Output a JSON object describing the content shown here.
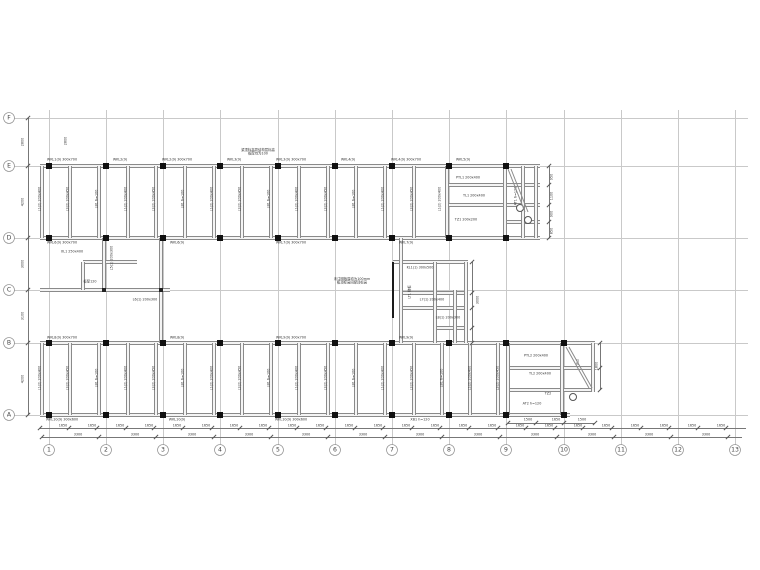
{
  "drawing": {
    "frame": {
      "x1": 14,
      "x2": 748,
      "y1": 110,
      "y2": 445,
      "bubble_row_y": 450,
      "bubble_col_x": 9
    },
    "cols": [
      {
        "n": "1",
        "x": 49
      },
      {
        "n": "2",
        "x": 106
      },
      {
        "n": "3",
        "x": 163
      },
      {
        "n": "4",
        "x": 220
      },
      {
        "n": "5",
        "x": 278
      },
      {
        "n": "6",
        "x": 335
      },
      {
        "n": "7",
        "x": 392
      },
      {
        "n": "8",
        "x": 449
      },
      {
        "n": "9",
        "x": 506
      },
      {
        "n": "10",
        "x": 564
      },
      {
        "n": "11",
        "x": 621
      },
      {
        "n": "12",
        "x": 678
      },
      {
        "n": "13",
        "x": 735
      }
    ],
    "rows": [
      {
        "n": "F",
        "y": 118
      },
      {
        "n": "E",
        "y": 166
      },
      {
        "n": "D",
        "y": 238
      },
      {
        "n": "C",
        "y": 290
      },
      {
        "n": "B",
        "y": 343
      },
      {
        "n": "A",
        "y": 415
      }
    ],
    "hbeams": [
      {
        "x": 40,
        "y": 166,
        "w": 500
      },
      {
        "x": 40,
        "y": 238,
        "w": 500
      },
      {
        "x": 447,
        "y": 185,
        "w": 93
      },
      {
        "x": 447,
        "y": 205,
        "w": 93
      },
      {
        "x": 506,
        "y": 222,
        "w": 34
      },
      {
        "x": 83,
        "y": 262,
        "w": 54
      },
      {
        "x": 40,
        "y": 290,
        "w": 130
      },
      {
        "x": 393,
        "y": 262,
        "w": 75
      },
      {
        "x": 401,
        "y": 293,
        "w": 67
      },
      {
        "x": 401,
        "y": 308,
        "w": 67
      },
      {
        "x": 435,
        "y": 328,
        "w": 33
      },
      {
        "x": 40,
        "y": 343,
        "w": 555
      },
      {
        "x": 40,
        "y": 415,
        "w": 530
      },
      {
        "x": 508,
        "y": 368,
        "w": 87
      },
      {
        "x": 508,
        "y": 390,
        "w": 87
      }
    ],
    "vbeams": [
      {
        "x": 42,
        "y": 166,
        "h": 72
      },
      {
        "x": 70,
        "y": 166,
        "h": 72
      },
      {
        "x": 99,
        "y": 166,
        "h": 72
      },
      {
        "x": 128,
        "y": 166,
        "h": 72
      },
      {
        "x": 156,
        "y": 166,
        "h": 72
      },
      {
        "x": 185,
        "y": 166,
        "h": 72
      },
      {
        "x": 214,
        "y": 166,
        "h": 72
      },
      {
        "x": 242,
        "y": 166,
        "h": 72
      },
      {
        "x": 271,
        "y": 166,
        "h": 72
      },
      {
        "x": 299,
        "y": 166,
        "h": 72
      },
      {
        "x": 328,
        "y": 166,
        "h": 72
      },
      {
        "x": 356,
        "y": 166,
        "h": 72
      },
      {
        "x": 385,
        "y": 166,
        "h": 72
      },
      {
        "x": 414,
        "y": 166,
        "h": 72
      },
      {
        "x": 447,
        "y": 166,
        "h": 72
      },
      {
        "x": 505,
        "y": 166,
        "h": 72
      },
      {
        "x": 523,
        "y": 166,
        "h": 72
      },
      {
        "x": 536,
        "y": 166,
        "h": 72
      },
      {
        "x": 104,
        "y": 238,
        "h": 52
      },
      {
        "x": 161,
        "y": 238,
        "h": 105
      },
      {
        "x": 83,
        "y": 262,
        "h": 28
      },
      {
        "x": 401,
        "y": 238,
        "h": 105
      },
      {
        "x": 435,
        "y": 262,
        "h": 81
      },
      {
        "x": 455,
        "y": 290,
        "h": 53
      },
      {
        "x": 466,
        "y": 262,
        "h": 81
      },
      {
        "x": 42,
        "y": 343,
        "h": 72
      },
      {
        "x": 70,
        "y": 343,
        "h": 72
      },
      {
        "x": 99,
        "y": 343,
        "h": 72
      },
      {
        "x": 128,
        "y": 343,
        "h": 72
      },
      {
        "x": 156,
        "y": 343,
        "h": 72
      },
      {
        "x": 185,
        "y": 343,
        "h": 72
      },
      {
        "x": 214,
        "y": 343,
        "h": 72
      },
      {
        "x": 242,
        "y": 343,
        "h": 72
      },
      {
        "x": 271,
        "y": 343,
        "h": 72
      },
      {
        "x": 299,
        "y": 343,
        "h": 72
      },
      {
        "x": 328,
        "y": 343,
        "h": 72
      },
      {
        "x": 356,
        "y": 343,
        "h": 72
      },
      {
        "x": 385,
        "y": 343,
        "h": 72
      },
      {
        "x": 414,
        "y": 343,
        "h": 72
      },
      {
        "x": 442,
        "y": 343,
        "h": 72
      },
      {
        "x": 470,
        "y": 343,
        "h": 72
      },
      {
        "x": 498,
        "y": 343,
        "h": 72
      },
      {
        "x": 508,
        "y": 343,
        "h": 72
      },
      {
        "x": 562,
        "y": 343,
        "h": 72
      },
      {
        "x": 593,
        "y": 343,
        "h": 49
      }
    ],
    "bold_lines": [
      {
        "x": 392,
        "y": 262,
        "h": 56
      }
    ],
    "columns": [
      {
        "x": 49,
        "y": 166
      },
      {
        "x": 106,
        "y": 166
      },
      {
        "x": 163,
        "y": 166
      },
      {
        "x": 220,
        "y": 166
      },
      {
        "x": 278,
        "y": 166
      },
      {
        "x": 335,
        "y": 166
      },
      {
        "x": 392,
        "y": 166
      },
      {
        "x": 449,
        "y": 166
      },
      {
        "x": 506,
        "y": 166
      },
      {
        "x": 49,
        "y": 238
      },
      {
        "x": 106,
        "y": 238
      },
      {
        "x": 163,
        "y": 238
      },
      {
        "x": 220,
        "y": 238
      },
      {
        "x": 278,
        "y": 238
      },
      {
        "x": 335,
        "y": 238
      },
      {
        "x": 392,
        "y": 238
      },
      {
        "x": 449,
        "y": 238
      },
      {
        "x": 506,
        "y": 238
      },
      {
        "x": 49,
        "y": 343
      },
      {
        "x": 106,
        "y": 343
      },
      {
        "x": 163,
        "y": 343
      },
      {
        "x": 220,
        "y": 343
      },
      {
        "x": 278,
        "y": 343
      },
      {
        "x": 335,
        "y": 343
      },
      {
        "x": 392,
        "y": 343
      },
      {
        "x": 449,
        "y": 343
      },
      {
        "x": 506,
        "y": 343
      },
      {
        "x": 564,
        "y": 343
      },
      {
        "x": 49,
        "y": 415
      },
      {
        "x": 106,
        "y": 415
      },
      {
        "x": 163,
        "y": 415
      },
      {
        "x": 220,
        "y": 415
      },
      {
        "x": 278,
        "y": 415
      },
      {
        "x": 335,
        "y": 415
      },
      {
        "x": 392,
        "y": 415
      },
      {
        "x": 449,
        "y": 415
      },
      {
        "x": 506,
        "y": 415
      },
      {
        "x": 564,
        "y": 415
      }
    ],
    "joints": [
      {
        "x": 104,
        "y": 290
      },
      {
        "x": 161,
        "y": 290
      }
    ],
    "circles": [
      {
        "x": 520,
        "y": 208
      },
      {
        "x": 528,
        "y": 220
      },
      {
        "x": 573,
        "y": 397
      }
    ],
    "diagonals": [
      {
        "x1": 508,
        "y1": 169,
        "x2": 525,
        "y2": 212
      },
      {
        "x1": 511,
        "y1": 169,
        "x2": 528,
        "y2": 212
      },
      {
        "x1": 566,
        "y1": 347,
        "x2": 589,
        "y2": 388
      },
      {
        "x1": 569,
        "y1": 347,
        "x2": 592,
        "y2": 388
      }
    ],
    "dim_lines": [
      {
        "o": "h",
        "x": 40,
        "y": 428,
        "len": 706,
        "step": 28.6
      },
      {
        "o": "h",
        "x": 42,
        "y": 437,
        "len": 700,
        "step": 57.2
      },
      {
        "o": "v",
        "x": 28,
        "y": 118,
        "len": 297,
        "ticks": [
          118,
          166,
          238,
          290,
          343,
          415
        ]
      },
      {
        "o": "v",
        "x": 549,
        "y": 166,
        "len": 72,
        "ticks": [
          166,
          185,
          205,
          222,
          238
        ]
      },
      {
        "o": "v",
        "x": 472,
        "y": 262,
        "len": 81,
        "ticks": [
          262,
          293,
          308,
          328,
          343
        ]
      },
      {
        "o": "h",
        "x": 508,
        "y": 423,
        "len": 87,
        "ticks": [
          508,
          536,
          564,
          595
        ]
      },
      {
        "o": "v",
        "x": 600,
        "y": 343,
        "len": 47,
        "ticks": [
          343,
          368,
          390
        ]
      }
    ],
    "dim_numbers": [
      {
        "t": "1650",
        "y": 426,
        "xs": [
          63,
          92,
          120,
          149,
          177,
          206,
          234,
          263,
          292,
          320,
          349,
          378,
          406,
          435,
          463,
          492,
          520,
          549,
          578,
          606,
          635,
          664,
          692,
          721
        ]
      },
      {
        "t": "3300",
        "y": 435,
        "xs": [
          78,
          135,
          192,
          249,
          306,
          363,
          420,
          478,
          535,
          592,
          649,
          706
        ]
      }
    ],
    "left_dims": [
      {
        "t": "2800",
        "x": 23,
        "y": 142
      },
      {
        "t": "4200",
        "x": 23,
        "y": 202
      },
      {
        "t": "3000",
        "x": 23,
        "y": 264
      },
      {
        "t": "3100",
        "x": 23,
        "y": 316
      },
      {
        "t": "4200",
        "x": 23,
        "y": 379
      }
    ],
    "labels": [
      {
        "t": "WKL1(9) 300x700",
        "x": 62,
        "y": 160,
        "r": 0
      },
      {
        "t": "WKL2(9)",
        "x": 120,
        "y": 160,
        "r": 0
      },
      {
        "t": "WKL2(9) 300x700",
        "x": 177,
        "y": 160,
        "r": 0
      },
      {
        "t": "WKL3(9)",
        "x": 234,
        "y": 160,
        "r": 0
      },
      {
        "t": "WKL3(9) 300x700",
        "x": 291,
        "y": 160,
        "r": 0
      },
      {
        "t": "WKL4(9)",
        "x": 348,
        "y": 160,
        "r": 0
      },
      {
        "t": "WKL4(9) 300x700",
        "x": 406,
        "y": 160,
        "r": 0
      },
      {
        "t": "WKL5(9)",
        "x": 463,
        "y": 160,
        "r": 0
      },
      {
        "t": "梁顶标高同结构层标高\n板厚均为100",
        "x": 258,
        "y": 152,
        "r": 0
      },
      {
        "t": "WKL6(9) 300x700",
        "x": 62,
        "y": 243,
        "r": 0
      },
      {
        "t": "WKL6(9)",
        "x": 177,
        "y": 243,
        "r": 0
      },
      {
        "t": "WKL7(9) 300x700",
        "x": 291,
        "y": 243,
        "r": 0
      },
      {
        "t": "WKL7(9)",
        "x": 406,
        "y": 243,
        "r": 0
      },
      {
        "t": "WKL8(9) 300x700",
        "x": 62,
        "y": 338,
        "r": 0
      },
      {
        "t": "WKL8(9)",
        "x": 177,
        "y": 338,
        "r": 0
      },
      {
        "t": "WKL9(9) 300x700",
        "x": 291,
        "y": 338,
        "r": 0
      },
      {
        "t": "WKL9(9)",
        "x": 406,
        "y": 338,
        "r": 0
      },
      {
        "t": "WKL10(9) 300x600",
        "x": 62,
        "y": 420,
        "r": 0
      },
      {
        "t": "WKL10(9)",
        "x": 177,
        "y": 420,
        "r": 0
      },
      {
        "t": "WKL10(9) 300x600",
        "x": 291,
        "y": 420,
        "r": 0
      },
      {
        "t": "XB1 h=120",
        "x": 420,
        "y": 420,
        "r": 0
      },
      {
        "t": "L1(2) 200x400",
        "x": 40,
        "y": 199,
        "r": 1
      },
      {
        "t": "L2(2) 200x450",
        "x": 68,
        "y": 199,
        "r": 1
      },
      {
        "t": "LB1 h=100",
        "x": 97,
        "y": 199,
        "r": 1
      },
      {
        "t": "L1(2) 200x400",
        "x": 126,
        "y": 199,
        "r": 1
      },
      {
        "t": "L2(2) 200x450",
        "x": 154,
        "y": 199,
        "r": 1
      },
      {
        "t": "LB1 h=100",
        "x": 183,
        "y": 199,
        "r": 1
      },
      {
        "t": "L1(2) 200x400",
        "x": 212,
        "y": 199,
        "r": 1
      },
      {
        "t": "L2(2) 200x450",
        "x": 240,
        "y": 199,
        "r": 1
      },
      {
        "t": "LB1 h=100",
        "x": 269,
        "y": 199,
        "r": 1
      },
      {
        "t": "L1(2) 200x400",
        "x": 297,
        "y": 199,
        "r": 1
      },
      {
        "t": "L2(2) 200x450",
        "x": 326,
        "y": 199,
        "r": 1
      },
      {
        "t": "LB1 h=100",
        "x": 354,
        "y": 199,
        "r": 1
      },
      {
        "t": "L1(2) 200x400",
        "x": 383,
        "y": 199,
        "r": 1
      },
      {
        "t": "L2(2) 200x450",
        "x": 412,
        "y": 199,
        "r": 1
      },
      {
        "t": "L1(2) 200x400",
        "x": 440,
        "y": 199,
        "r": 1
      },
      {
        "t": "L1(2) 200x400",
        "x": 40,
        "y": 378,
        "r": 1
      },
      {
        "t": "L2(2) 200x450",
        "x": 68,
        "y": 378,
        "r": 1
      },
      {
        "t": "LB1 h=100",
        "x": 97,
        "y": 378,
        "r": 1
      },
      {
        "t": "L1(2) 200x400",
        "x": 126,
        "y": 378,
        "r": 1
      },
      {
        "t": "L2(2) 200x450",
        "x": 154,
        "y": 378,
        "r": 1
      },
      {
        "t": "LB1 h=100",
        "x": 183,
        "y": 378,
        "r": 1
      },
      {
        "t": "L1(2) 200x400",
        "x": 212,
        "y": 378,
        "r": 1
      },
      {
        "t": "L2(2) 200x450",
        "x": 240,
        "y": 378,
        "r": 1
      },
      {
        "t": "LB1 h=100",
        "x": 269,
        "y": 378,
        "r": 1
      },
      {
        "t": "L1(2) 200x400",
        "x": 297,
        "y": 378,
        "r": 1
      },
      {
        "t": "L2(2) 200x450",
        "x": 326,
        "y": 378,
        "r": 1
      },
      {
        "t": "LB1 h=100",
        "x": 354,
        "y": 378,
        "r": 1
      },
      {
        "t": "L1(2) 200x400",
        "x": 383,
        "y": 378,
        "r": 1
      },
      {
        "t": "L2(2) 200x450",
        "x": 412,
        "y": 378,
        "r": 1
      },
      {
        "t": "LB1 h=100",
        "x": 442,
        "y": 378,
        "r": 1
      },
      {
        "t": "L1(2) 200x400",
        "x": 470,
        "y": 378,
        "r": 1
      },
      {
        "t": "L2(2) 200x450",
        "x": 498,
        "y": 378,
        "r": 1
      },
      {
        "t": "XL1 250x400",
        "x": 72,
        "y": 252,
        "r": 0
      },
      {
        "t": "L5(1) 200x300",
        "x": 112,
        "y": 258,
        "r": 1
      },
      {
        "t": "L6(1) 200x300",
        "x": 145,
        "y": 300,
        "r": 0
      },
      {
        "t": "板厚120",
        "x": 90,
        "y": 282,
        "r": 0
      },
      {
        "t": "未注明板厚均为100mm\n板顶标高同梁顶标高",
        "x": 352,
        "y": 281,
        "r": 0
      },
      {
        "t": "KL1(1) 300x500",
        "x": 420,
        "y": 268,
        "r": 0
      },
      {
        "t": "L7(1) 200x400",
        "x": 432,
        "y": 300,
        "r": 0
      },
      {
        "t": "L8(1) 200x300",
        "x": 448,
        "y": 318,
        "r": 0
      },
      {
        "t": "LT1 梯板",
        "x": 410,
        "y": 292,
        "r": 1
      },
      {
        "t": "3000",
        "x": 478,
        "y": 300,
        "r": 1
      },
      {
        "t": "PTL1 200x400",
        "x": 468,
        "y": 178,
        "r": 0
      },
      {
        "t": "TL1 200x400",
        "x": 474,
        "y": 196,
        "r": 0
      },
      {
        "t": "TZ1 200x200",
        "x": 466,
        "y": 220,
        "r": 0
      },
      {
        "t": "AT1 h=120",
        "x": 516,
        "y": 196,
        "r": 1
      },
      {
        "t": "950",
        "x": 552,
        "y": 177,
        "r": 1
      },
      {
        "t": "1100",
        "x": 552,
        "y": 196,
        "r": 1
      },
      {
        "t": "900",
        "x": 552,
        "y": 214,
        "r": 1
      },
      {
        "t": "850",
        "x": 552,
        "y": 231,
        "r": 1
      },
      {
        "t": "2800",
        "x": 66,
        "y": 141,
        "r": 1
      },
      {
        "t": "PTL2 200x400",
        "x": 536,
        "y": 356,
        "r": 0
      },
      {
        "t": "TL2 200x400",
        "x": 540,
        "y": 374,
        "r": 0
      },
      {
        "t": "TZ2",
        "x": 548,
        "y": 394,
        "r": 0
      },
      {
        "t": "AT2 h=120",
        "x": 532,
        "y": 404,
        "r": 0
      },
      {
        "t": "XL2",
        "x": 578,
        "y": 362,
        "r": 1
      },
      {
        "t": "1800",
        "x": 597,
        "y": 366,
        "r": 1
      },
      {
        "t": "1500",
        "x": 528,
        "y": 420,
        "r": 0
      },
      {
        "t": "1650",
        "x": 556,
        "y": 420,
        "r": 0
      },
      {
        "t": "1500",
        "x": 582,
        "y": 420,
        "r": 0
      }
    ]
  }
}
